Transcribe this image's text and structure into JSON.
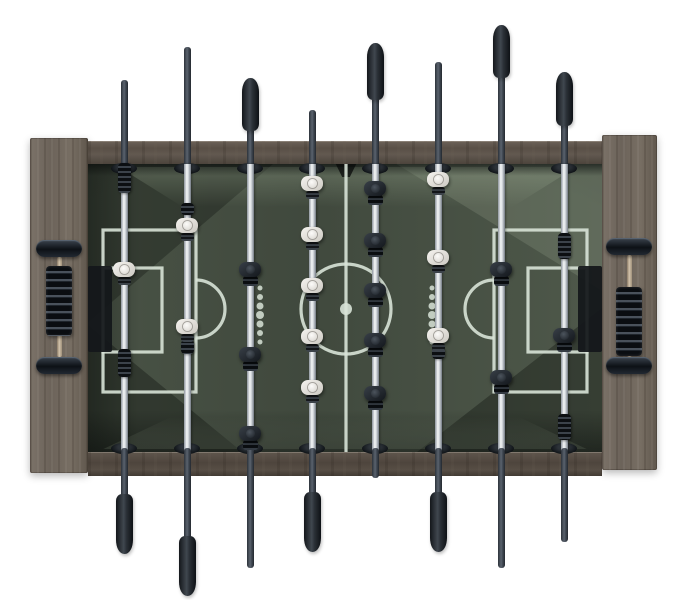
{
  "scene": {
    "type": "product-photo",
    "subject": "foosball-table-top-view",
    "colors": {
      "bg": "#ffffff",
      "wood_rail": "#594f46",
      "wood_panel": "#6f665c",
      "field": "#4e584a",
      "field_light": "#76826e",
      "line": "#d8e3d7",
      "goal": "#14171b",
      "rod_metal": "#e9edef",
      "rod_steel_dark": "#3a424c",
      "player_white": "#e9e7e2",
      "player_black": "#1c2126",
      "grip_black": "#23282d",
      "score_rod_brass": "#c3b094"
    },
    "table": {
      "x": 30,
      "y": 135,
      "w": 627,
      "h": 341,
      "panel_left": {
        "x": 30,
        "y": 138,
        "w": 58,
        "h": 335
      },
      "panel_right": {
        "x": 602,
        "y": 135,
        "w": 55,
        "h": 335
      },
      "rail_top": {
        "x": 88,
        "y": 141,
        "w": 514,
        "h": 23
      },
      "rail_bottom": {
        "x": 88,
        "y": 452,
        "w": 514,
        "h": 24
      }
    },
    "playfield": {
      "x": 88,
      "y": 164,
      "w": 514,
      "h": 288,
      "markings": {
        "line_width": 3.2,
        "center_line_x": 258,
        "center_circle": {
          "cx": 258,
          "cy": 145,
          "r": 45
        },
        "center_dot_r": 6,
        "boxes": [
          {
            "x": 15,
            "y": 66,
            "w": 93,
            "h": 162
          },
          {
            "x": 15,
            "y": 104,
            "w": 59,
            "h": 84
          },
          {
            "x": 406,
            "y": 66,
            "w": 93,
            "h": 162
          },
          {
            "x": 440,
            "y": 104,
            "w": 59,
            "h": 84
          }
        ],
        "penalty_arcs": [
          {
            "cx": 108,
            "cy": 145,
            "r": 29,
            "bulge": "right"
          },
          {
            "cx": 406,
            "cy": 145,
            "r": 29,
            "bulge": "left"
          }
        ],
        "goals": [
          {
            "x": 0,
            "y": 102,
            "w": 24,
            "h": 86
          },
          {
            "x": 490,
            "y": 102,
            "w": 24,
            "h": 86
          }
        ],
        "dot_columns": [
          {
            "x": 172,
            "ys": [
              124,
              133,
              142,
              151,
              160,
              169,
              178
            ],
            "rs": [
              2.5,
              3,
              3.5,
              4,
              3.5,
              3,
              2.5
            ]
          },
          {
            "x": 344,
            "ys": [
              124,
              133,
              142,
              151,
              160,
              169,
              178
            ],
            "rs": [
              2.5,
              3,
              3.5,
              4,
              3.5,
              3,
              2.5
            ]
          }
        ]
      }
    },
    "field_inner_top_y": 164,
    "field_inner_bottom_y": 452,
    "bearing_ys": [
      163,
      443
    ],
    "rods": [
      {
        "id": 1,
        "x": 124,
        "team": "white",
        "role": "goalie",
        "tip_top": 80,
        "tip_bottom": 554,
        "grip": {
          "side": "bottom",
          "from": 494,
          "to": 554
        },
        "players": [
          271
        ],
        "bumpers": [
          [
            178,
            30
          ],
          [
            363,
            28
          ]
        ]
      },
      {
        "id": 2,
        "x": 187,
        "team": "white",
        "role": "defense",
        "tip_top": 47,
        "tip_bottom": 596,
        "grip": {
          "side": "bottom",
          "from": 536,
          "to": 596
        },
        "players": [
          227,
          328
        ],
        "bumpers": [
          [
            209,
            12
          ],
          [
            347,
            14
          ]
        ]
      },
      {
        "id": 3,
        "x": 250,
        "team": "black",
        "role": "attack",
        "tip_top": 78,
        "tip_bottom": 568,
        "grip": {
          "side": "top",
          "from": 78,
          "to": 131
        },
        "players": [
          272,
          357,
          436
        ],
        "bumpers": []
      },
      {
        "id": 4,
        "x": 312,
        "team": "white",
        "role": "midfield",
        "tip_top": 110,
        "tip_bottom": 552,
        "grip": {
          "side": "bottom",
          "from": 492,
          "to": 552
        },
        "players": [
          185,
          236,
          287,
          338,
          389
        ],
        "bumpers": []
      },
      {
        "id": 5,
        "x": 375,
        "team": "black",
        "role": "midfield",
        "tip_top": 43,
        "tip_bottom": 478,
        "grip": {
          "side": "top",
          "from": 43,
          "to": 100
        },
        "players": [
          191,
          243,
          293,
          343,
          396
        ],
        "bumpers": []
      },
      {
        "id": 6,
        "x": 438,
        "team": "white",
        "role": "attack",
        "tip_top": 62,
        "tip_bottom": 552,
        "grip": {
          "side": "bottom",
          "from": 492,
          "to": 552
        },
        "players": [
          181,
          259,
          337
        ],
        "bumpers": [
          [
            353,
            12
          ]
        ]
      },
      {
        "id": 7,
        "x": 501,
        "team": "black",
        "role": "defense",
        "tip_top": 25,
        "tip_bottom": 568,
        "grip": {
          "side": "top",
          "from": 25,
          "to": 78
        },
        "players": [
          272,
          380
        ],
        "bumpers": []
      },
      {
        "id": 8,
        "x": 564,
        "team": "black",
        "role": "goalie",
        "tip_top": 72,
        "tip_bottom": 542,
        "grip": {
          "side": "top",
          "from": 72,
          "to": 126
        },
        "players": [
          338
        ],
        "bumpers": [
          [
            246,
            26
          ],
          [
            427,
            26
          ]
        ]
      }
    ],
    "score_units": [
      {
        "side": "left",
        "cx": 59,
        "bracket_w": 46,
        "bracket_top_y": 240,
        "bracket_bottom_y": 357,
        "bracket_h": 17,
        "rod": [
          257,
          357
        ],
        "beads": [
          266,
          336
        ],
        "bead_w": 26
      },
      {
        "side": "right",
        "cx": 629,
        "bracket_w": 46,
        "bracket_top_y": 238,
        "bracket_bottom_y": 357,
        "bracket_h": 17,
        "rod": [
          255,
          357
        ],
        "beads": [
          287,
          356
        ],
        "bead_w": 26
      }
    ]
  }
}
